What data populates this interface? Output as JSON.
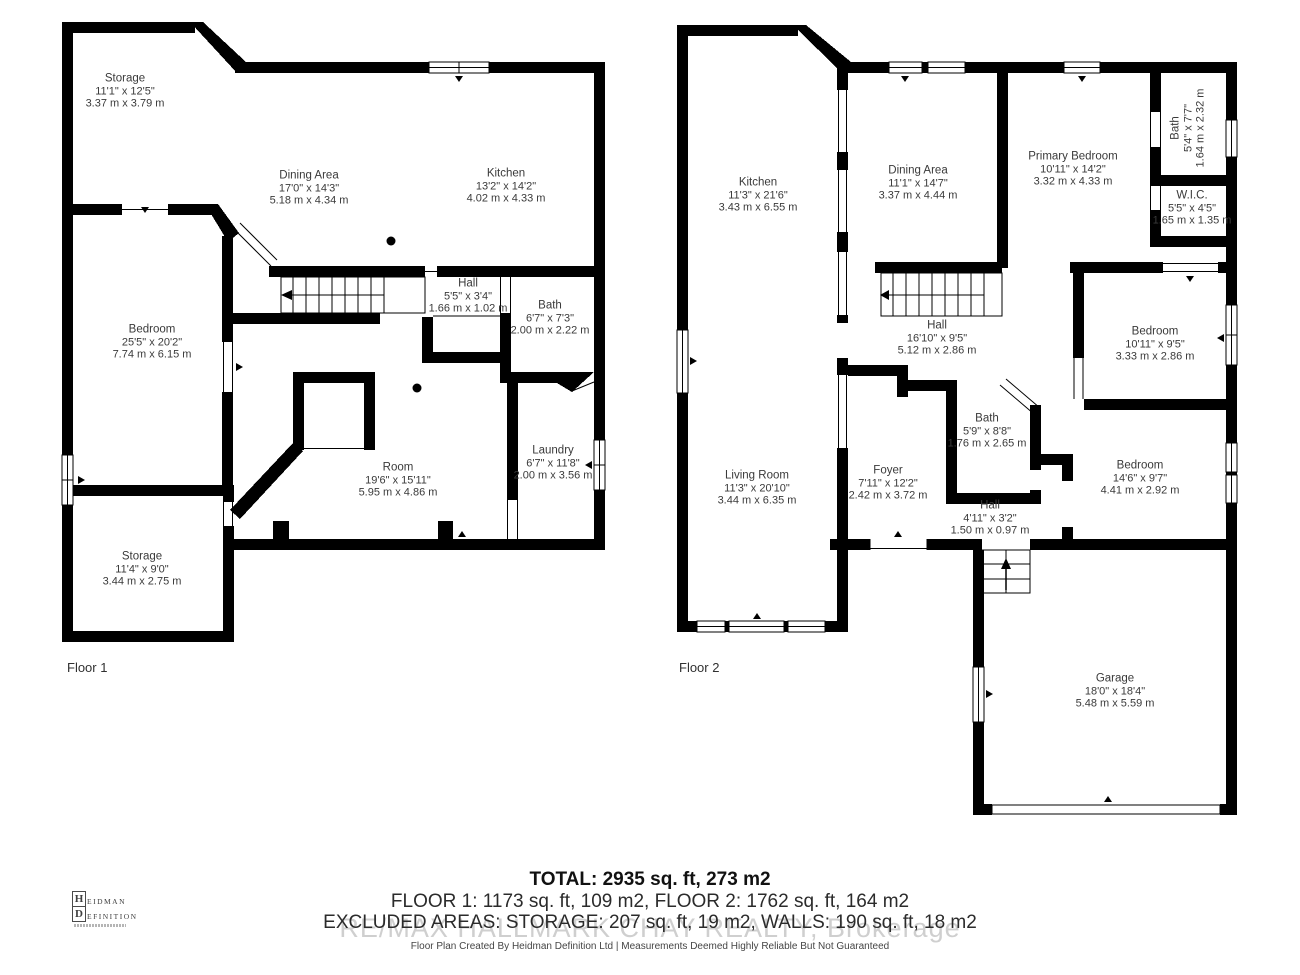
{
  "floor1": {
    "label": "Floor 1",
    "rooms": {
      "storage_top": {
        "name": "Storage",
        "imperial": "11'1\" x 12'5\"",
        "metric": "3.37 m x 3.79 m"
      },
      "dining": {
        "name": "Dining Area",
        "imperial": "17'0\" x 14'3\"",
        "metric": "5.18 m x 4.34 m"
      },
      "kitchen": {
        "name": "Kitchen",
        "imperial": "13'2\" x 14'2\"",
        "metric": "4.02 m x 4.33 m"
      },
      "hall": {
        "name": "Hall",
        "imperial": "5'5\" x 3'4\"",
        "metric": "1.66 m x 1.02 m"
      },
      "bath": {
        "name": "Bath",
        "imperial": "6'7\" x 7'3\"",
        "metric": "2.00 m x 2.22 m"
      },
      "bedroom": {
        "name": "Bedroom",
        "imperial": "25'5\" x 20'2\"",
        "metric": "7.74 m x 6.15 m"
      },
      "room": {
        "name": "Room",
        "imperial": "19'6\" x 15'11\"",
        "metric": "5.95 m x 4.86 m"
      },
      "laundry": {
        "name": "Laundry",
        "imperial": "6'7\" x 11'8\"",
        "metric": "2.00 m x 3.56 m"
      },
      "storage_bottom": {
        "name": "Storage",
        "imperial": "11'4\" x 9'0\"",
        "metric": "3.44 m x 2.75 m"
      }
    }
  },
  "floor2": {
    "label": "Floor 2",
    "rooms": {
      "kitchen": {
        "name": "Kitchen",
        "imperial": "11'3\" x 21'6\"",
        "metric": "3.43 m x 6.55 m"
      },
      "dining": {
        "name": "Dining Area",
        "imperial": "11'1\" x 14'7\"",
        "metric": "3.37 m x 4.44 m"
      },
      "primary_bedroom": {
        "name": "Primary Bedroom",
        "imperial": "10'11\" x 14'2\"",
        "metric": "3.32 m x 4.33 m"
      },
      "bath_top": {
        "name": "Bath",
        "imperial": "5'4\" x 7'7\"",
        "metric": "1.64 m x 2.32 m"
      },
      "wic": {
        "name": "W.I.C.",
        "imperial": "5'5\" x 4'5\"",
        "metric": "1.65 m x 1.35 m"
      },
      "hall": {
        "name": "Hall",
        "imperial": "16'10\" x 9'5\"",
        "metric": "5.12 m x 2.86 m"
      },
      "bedroom_mid": {
        "name": "Bedroom",
        "imperial": "10'11\" x 9'5\"",
        "metric": "3.33 m x 2.86 m"
      },
      "bath_mid": {
        "name": "Bath",
        "imperial": "5'9\" x 8'8\"",
        "metric": "1.76 m x 2.65 m"
      },
      "living": {
        "name": "Living Room",
        "imperial": "11'3\" x 20'10\"",
        "metric": "3.44 m x 6.35 m"
      },
      "foyer": {
        "name": "Foyer",
        "imperial": "7'11\" x 12'2\"",
        "metric": "2.42 m x 3.72 m"
      },
      "hall_small": {
        "name": "Hall",
        "imperial": "4'11\" x 3'2\"",
        "metric": "1.50 m x 0.97 m"
      },
      "bedroom_low": {
        "name": "Bedroom",
        "imperial": "14'6\" x 9'7\"",
        "metric": "4.41 m x 2.92 m"
      },
      "garage": {
        "name": "Garage",
        "imperial": "18'0\" x 18'4\"",
        "metric": "5.48 m x 5.59 m"
      }
    }
  },
  "footer": {
    "total": "TOTAL: 2935 sq. ft, 273 m2",
    "floors_line": "FLOOR 1: 1173 sq. ft, 109 m2, FLOOR 2: 1762 sq. ft, 164 m2",
    "excluded_line": "EXCLUDED AREAS: STORAGE: 207 sq. ft, 19 m2, WALLS: 190 sq. ft, 18 m2",
    "watermark": "RE/MAX HALLMARK CHAY REALTY, Brokerage",
    "credit": "Floor Plan Created By Heidman Definition Ltd | Measurements Deemed Highly Reliable But Not Guaranteed"
  },
  "logo": {
    "h": "H",
    "eidman": "EIDMAN",
    "d": "D",
    "efinition": "EFINITION"
  },
  "colors": {
    "wall": "#000000",
    "label_text": "#3a3a3a",
    "watermark": "#c7c7c7"
  }
}
